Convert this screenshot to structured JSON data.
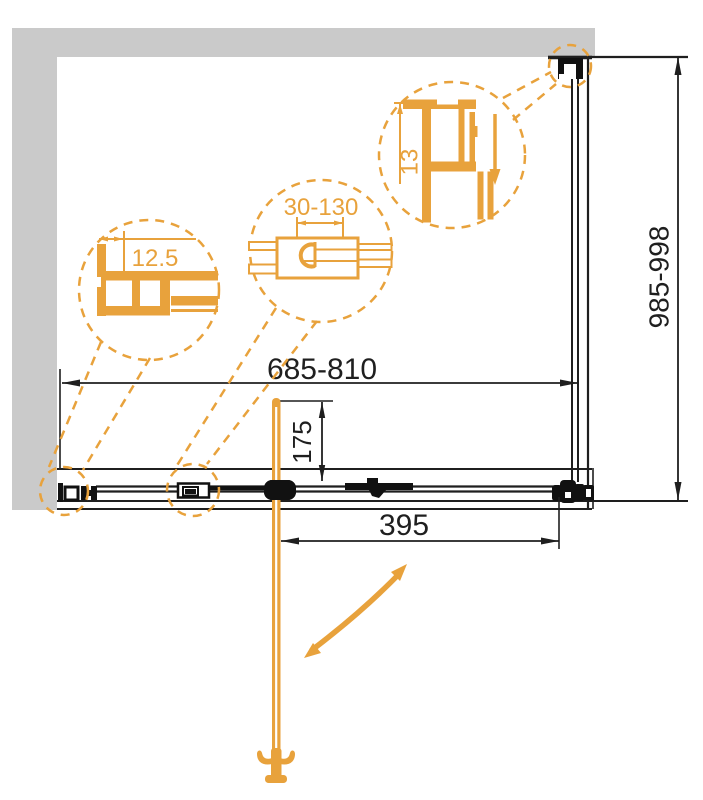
{
  "drawing": {
    "type": "technical-diagram",
    "subject": "shower enclosure sliding door plan view",
    "dimensions": {
      "width_range": "685-810",
      "height_range": "985-998",
      "door_opening": "395",
      "handle_offset": "175"
    },
    "detail_callouts": {
      "wall_profile": "12.5",
      "adjustment_range": "30-130",
      "profile_depth": "13"
    },
    "colors": {
      "accent_orange": "#E8A23C",
      "wall_gray": "#CACACA",
      "line_black": "#1F1F1F"
    }
  }
}
